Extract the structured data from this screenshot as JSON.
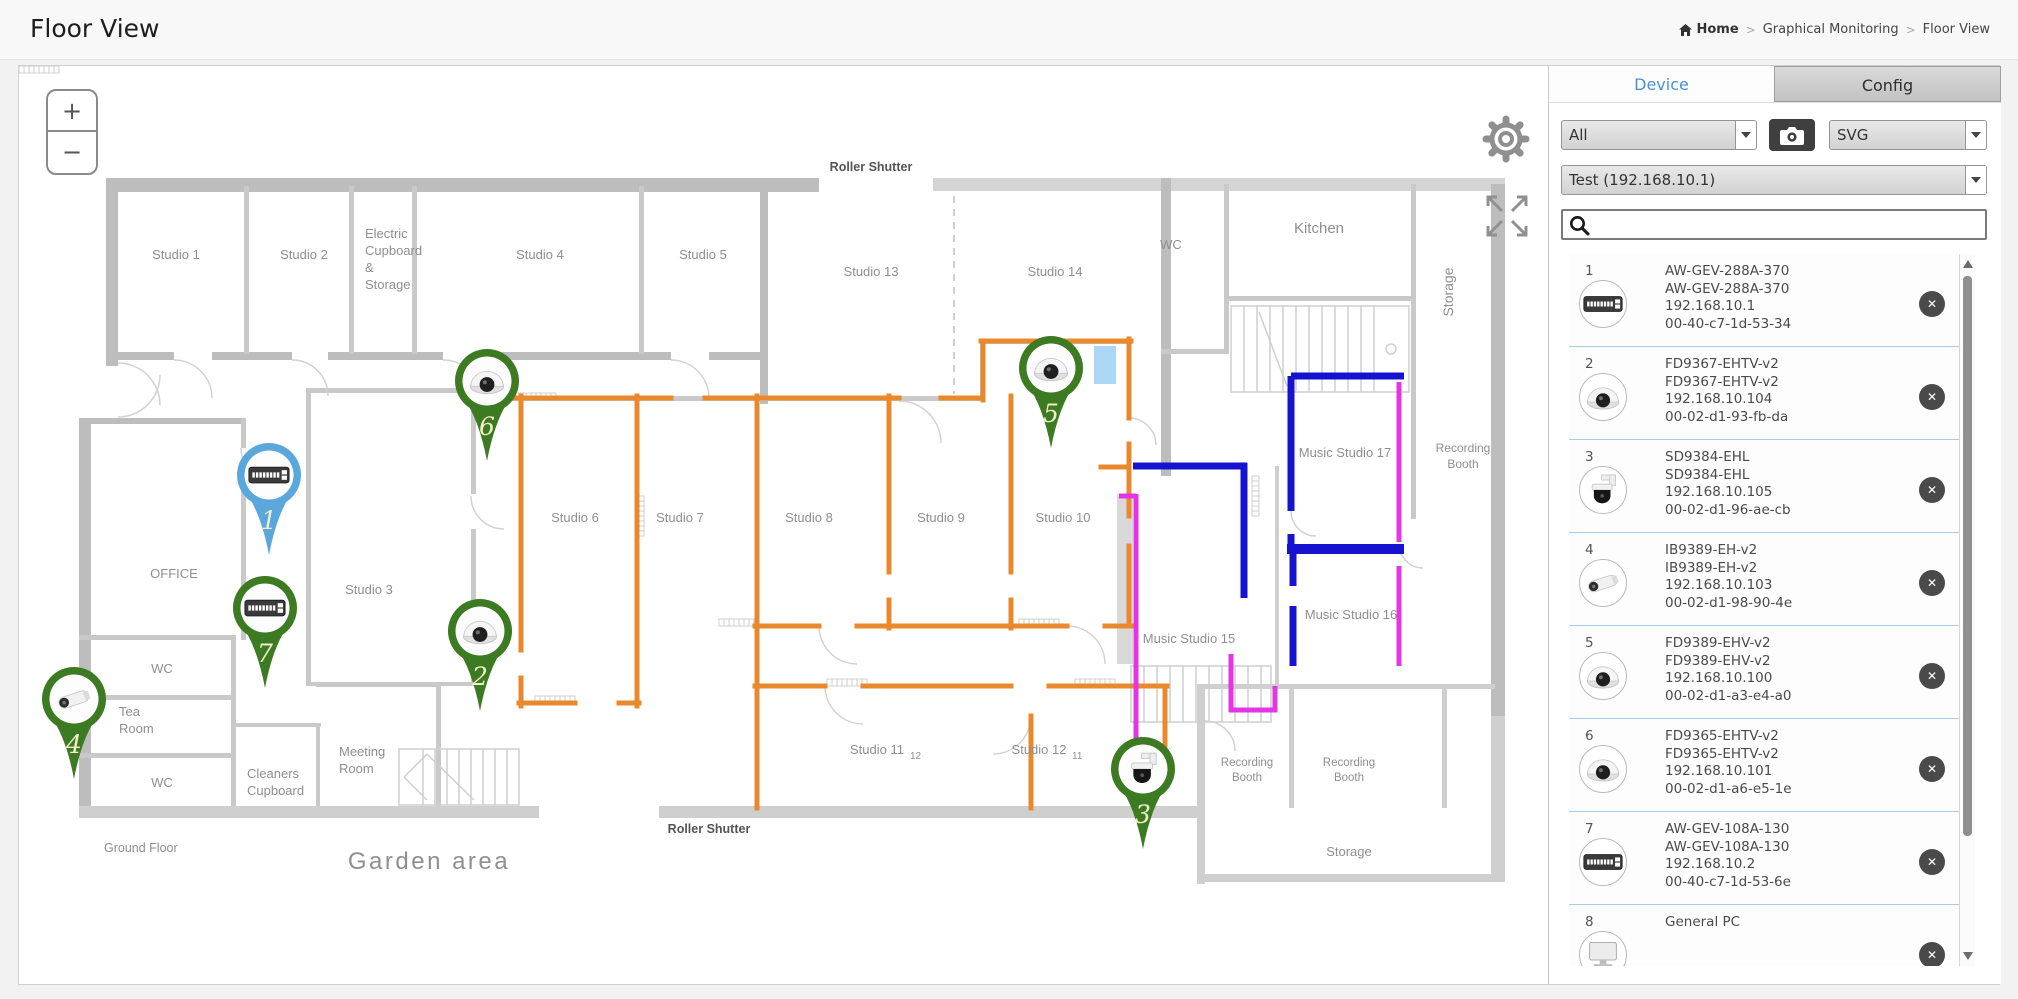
{
  "header": {
    "title": "Floor View",
    "breadcrumb": {
      "home": "Home",
      "sep1": ">",
      "item1": "Graphical Monitoring",
      "sep2": ">",
      "item2": "Floor View"
    }
  },
  "panel": {
    "tabs": {
      "device": "Device",
      "config": "Config"
    },
    "filter_select": "All",
    "format_select": "SVG",
    "device_select": "Test (192.168.10.1)",
    "search_value": "",
    "delete_glyph": "✕",
    "devices": [
      {
        "num": "1",
        "type": "switch",
        "name": "AW-GEV-288A-370",
        "model": "AW-GEV-288A-370",
        "ip": "192.168.10.1",
        "mac": "00-40-c7-1d-53-34"
      },
      {
        "num": "2",
        "type": "dome",
        "name": "FD9367-EHTV-v2",
        "model": "FD9367-EHTV-v2",
        "ip": "192.168.10.104",
        "mac": "00-02-d1-93-fb-da"
      },
      {
        "num": "3",
        "type": "ptz",
        "name": "SD9384-EHL",
        "model": "SD9384-EHL",
        "ip": "192.168.10.105",
        "mac": "00-02-d1-96-ae-cb"
      },
      {
        "num": "4",
        "type": "bullet",
        "name": "IB9389-EH-v2",
        "model": "IB9389-EH-v2",
        "ip": "192.168.10.103",
        "mac": "00-02-d1-98-90-4e"
      },
      {
        "num": "5",
        "type": "dome",
        "name": "FD9389-EHV-v2",
        "model": "FD9389-EHV-v2",
        "ip": "192.168.10.100",
        "mac": "00-02-d1-a3-e4-a0"
      },
      {
        "num": "6",
        "type": "dome",
        "name": "FD9365-EHTV-v2",
        "model": "FD9365-EHTV-v2",
        "ip": "192.168.10.101",
        "mac": "00-02-d1-a6-e5-1e"
      },
      {
        "num": "7",
        "type": "switch",
        "name": "AW-GEV-108A-130",
        "model": "AW-GEV-108A-130",
        "ip": "192.168.10.2",
        "mac": "00-40-c7-1d-53-6e"
      },
      {
        "num": "8",
        "type": "pc",
        "name": "General PC",
        "model": "",
        "ip": "",
        "mac": ""
      }
    ]
  },
  "map": {
    "zoom_in": "+",
    "zoom_out": "−",
    "pins": [
      {
        "num": "1",
        "type": "switch",
        "variant": "blue",
        "x": 250,
        "y": 409
      },
      {
        "num": "2",
        "type": "dome",
        "variant": "green",
        "x": 461,
        "y": 565
      },
      {
        "num": "3",
        "type": "ptz",
        "variant": "green",
        "x": 1124,
        "y": 703
      },
      {
        "num": "4",
        "type": "bullet",
        "variant": "green",
        "x": 55,
        "y": 633
      },
      {
        "num": "5",
        "type": "dome",
        "variant": "green",
        "x": 1032,
        "y": 302
      },
      {
        "num": "6",
        "type": "dome",
        "variant": "green",
        "x": 468,
        "y": 315
      },
      {
        "num": "7",
        "type": "switch",
        "variant": "green",
        "x": 246,
        "y": 542
      }
    ],
    "labels": [
      {
        "t": "Studio 1",
        "x": 157,
        "y": 193
      },
      {
        "t": "Studio 2",
        "x": 285,
        "y": 193
      },
      {
        "t": "Electric",
        "x": 346,
        "y": 172,
        "anchor": "start"
      },
      {
        "t": "Cupboard",
        "x": 346,
        "y": 189,
        "anchor": "start"
      },
      {
        "t": "&",
        "x": 346,
        "y": 206,
        "anchor": "start"
      },
      {
        "t": "Storage",
        "x": 346,
        "y": 223,
        "anchor": "start"
      },
      {
        "t": "Studio 4",
        "x": 521,
        "y": 193
      },
      {
        "t": "Studio 5",
        "x": 684,
        "y": 193
      },
      {
        "t": "Studio 13",
        "x": 852,
        "y": 210
      },
      {
        "t": "Studio 14",
        "x": 1036,
        "y": 210
      },
      {
        "t": "WC",
        "x": 1152,
        "y": 183
      },
      {
        "t": "Kitchen",
        "x": 1300,
        "y": 167,
        "size": 15
      },
      {
        "t": "Storage",
        "x": 1434,
        "y": 226,
        "rotate": -90,
        "size": 14
      },
      {
        "t": "OFFICE",
        "x": 155,
        "y": 512
      },
      {
        "t": "Studio 3",
        "x": 350,
        "y": 528
      },
      {
        "t": "Studio 6",
        "x": 556,
        "y": 456
      },
      {
        "t": "Studio 7",
        "x": 661,
        "y": 456
      },
      {
        "t": "Studio 8",
        "x": 790,
        "y": 456
      },
      {
        "t": "Studio 9",
        "x": 922,
        "y": 456
      },
      {
        "t": "Studio 10",
        "x": 1044,
        "y": 456
      },
      {
        "t": "Music Studio 17",
        "x": 1326,
        "y": 391
      },
      {
        "t": "Recording",
        "x": 1444,
        "y": 386,
        "size": 12
      },
      {
        "t": "Booth",
        "x": 1444,
        "y": 402,
        "size": 12
      },
      {
        "t": "Music Studio 15",
        "x": 1170,
        "y": 577
      },
      {
        "t": "Music Studio 16",
        "x": 1332,
        "y": 553
      },
      {
        "t": "Studio 11",
        "x": 858,
        "y": 688,
        "sub": "12"
      },
      {
        "t": "Studio 12",
        "x": 1020,
        "y": 688,
        "sub": "11"
      },
      {
        "t": "Recording",
        "x": 1228,
        "y": 700,
        "size": 11.5
      },
      {
        "t": "Booth",
        "x": 1228,
        "y": 715,
        "size": 11.5
      },
      {
        "t": "Recording",
        "x": 1330,
        "y": 700,
        "size": 11.5
      },
      {
        "t": "Booth",
        "x": 1330,
        "y": 715,
        "size": 11.5
      },
      {
        "t": "Storage",
        "x": 1330,
        "y": 790
      },
      {
        "t": "WC",
        "x": 143,
        "y": 607
      },
      {
        "t": "Tea",
        "x": 100,
        "y": 650,
        "anchor": "start"
      },
      {
        "t": "Room",
        "x": 100,
        "y": 667,
        "anchor": "start"
      },
      {
        "t": "WC",
        "x": 143,
        "y": 721
      },
      {
        "t": "Cleaners",
        "x": 228,
        "y": 712,
        "anchor": "start"
      },
      {
        "t": "Cupboard",
        "x": 228,
        "y": 729,
        "anchor": "start"
      },
      {
        "t": "Meeting",
        "x": 320,
        "y": 690,
        "anchor": "start"
      },
      {
        "t": "Room",
        "x": 320,
        "y": 707,
        "anchor": "start"
      },
      {
        "t": "Roller Shutter",
        "x": 852,
        "y": 105,
        "dark": true,
        "bold": true,
        "size": 12.5
      },
      {
        "t": "Roller Shutter",
        "x": 690,
        "y": 767,
        "dark": true,
        "bold": true,
        "size": 12.5
      },
      {
        "t": "Ground Floor",
        "x": 85,
        "y": 786,
        "anchor": "start",
        "size": 12.5
      },
      {
        "t": "Garden area",
        "x": 410,
        "y": 803,
        "size": 24,
        "spacing": 2.5
      }
    ]
  },
  "colors": {
    "accent_blue": "#4a90d9",
    "pin_green": "#3c7b22",
    "pin_blue": "#5aa8db",
    "pin_number": "#f2eec6",
    "route_orange": "#e8892e",
    "route_blue": "#1512d0",
    "route_magenta": "#e335e3"
  }
}
